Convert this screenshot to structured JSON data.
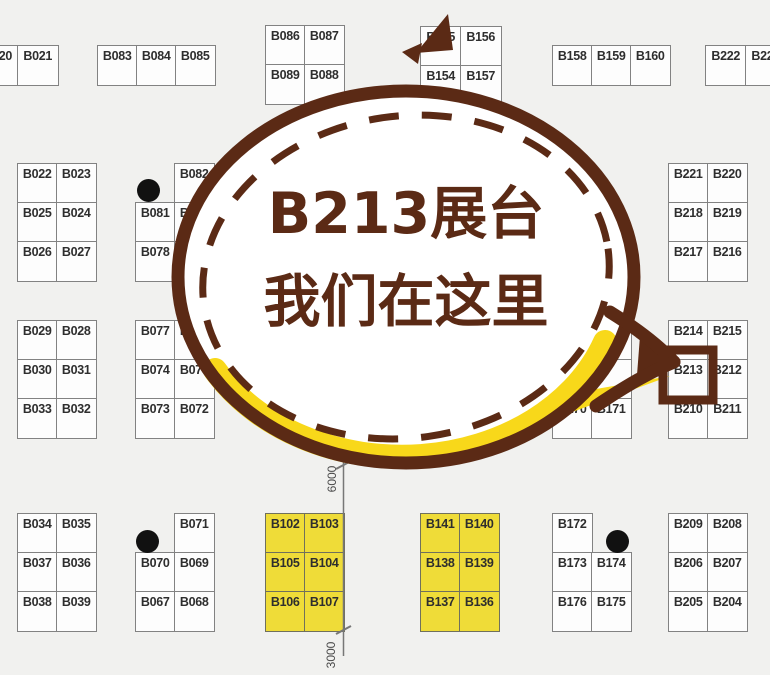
{
  "callout": {
    "line1": "B213展台",
    "line2": "我们在这里",
    "target_booth": "B213"
  },
  "dimension_labels": {
    "top": "6000",
    "bottom": "3000"
  },
  "colors": {
    "brown": "#5B2A15",
    "yellow_accent": "#F8D81A",
    "booth_yellow": "#EFDC38",
    "grid_gray": "#828282",
    "background": "#F1F1EF"
  },
  "blocks": [
    {
      "id": "blk-b020",
      "x": -23,
      "y": 45,
      "cw": 40,
      "ch": 39,
      "fill": "white",
      "rows": [
        [
          "B020",
          "B021"
        ]
      ]
    },
    {
      "id": "blk-b083",
      "x": 97,
      "y": 45,
      "cw": 39,
      "ch": 39,
      "fill": "white",
      "rows": [
        [
          "B083",
          "B084",
          "B085"
        ]
      ]
    },
    {
      "id": "blk-b086",
      "x": 265,
      "y": 25,
      "cw": 39,
      "ch": 39,
      "fill": "white",
      "rows": [
        [
          "B086",
          "B087"
        ],
        [
          "B089",
          "B088"
        ]
      ]
    },
    {
      "id": "blk-b155",
      "x": 420,
      "y": 26,
      "cw": 40,
      "ch": 39,
      "fill": "white",
      "rows": [
        [
          "B155",
          "B156"
        ],
        [
          "B154",
          "B157"
        ]
      ]
    },
    {
      "id": "blk-b158",
      "x": 552,
      "y": 45,
      "cw": 39,
      "ch": 39,
      "fill": "white",
      "rows": [
        [
          "B158",
          "B159",
          "B160"
        ]
      ]
    },
    {
      "id": "blk-b222",
      "x": 705,
      "y": 45,
      "cw": 40,
      "ch": 39,
      "fill": "white",
      "rows": [
        [
          "B222",
          "B223"
        ]
      ]
    },
    {
      "id": "blk-b022",
      "x": 17,
      "y": 163,
      "cw": 39,
      "ch": 39,
      "fill": "white",
      "rows": [
        [
          "B022",
          "B023"
        ],
        [
          "B025",
          "B024"
        ],
        [
          "B026",
          "B027"
        ]
      ]
    },
    {
      "id": "blk-b082",
      "x": 135,
      "y": 163,
      "cw": 39,
      "ch": 39,
      "fill": "white",
      "rows": [
        [
          null,
          "B082"
        ],
        [
          "B081",
          "B080"
        ],
        [
          "B078",
          "B079"
        ]
      ]
    },
    {
      "id": "blk-b221",
      "x": 668,
      "y": 163,
      "cw": 39,
      "ch": 39,
      "fill": "white",
      "rows": [
        [
          "B221",
          "B220"
        ],
        [
          "B218",
          "B219"
        ],
        [
          "B217",
          "B216"
        ]
      ]
    },
    {
      "id": "blk-b029",
      "x": 17,
      "y": 320,
      "cw": 39,
      "ch": 39,
      "fill": "white",
      "rows": [
        [
          "B029",
          "B028"
        ],
        [
          "B030",
          "B031"
        ],
        [
          "B033",
          "B032"
        ]
      ]
    },
    {
      "id": "blk-b077",
      "x": 135,
      "y": 320,
      "cw": 39,
      "ch": 39,
      "fill": "white",
      "rows": [
        [
          "B077",
          "B076"
        ],
        [
          "B074",
          "B075"
        ],
        [
          "B073",
          "B072"
        ]
      ]
    },
    {
      "id": "blk-b170",
      "x": 552,
      "y": 320,
      "cw": 39,
      "ch": 39,
      "fill": "white",
      "rows": [
        [
          "",
          "B167"
        ],
        [
          "",
          ""
        ],
        [
          "B170",
          "B171"
        ]
      ]
    },
    {
      "id": "blk-b214",
      "x": 668,
      "y": 320,
      "cw": 39,
      "ch": 39,
      "fill": "white",
      "rows": [
        [
          "B214",
          "B215"
        ],
        [
          "B213",
          "B212"
        ],
        [
          "B210",
          "B211"
        ]
      ]
    },
    {
      "id": "blk-b034",
      "x": 17,
      "y": 513,
      "cw": 39,
      "ch": 39,
      "fill": "white",
      "rows": [
        [
          "B034",
          "B035"
        ],
        [
          "B037",
          "B036"
        ],
        [
          "B038",
          "B039"
        ]
      ]
    },
    {
      "id": "blk-b071",
      "x": 135,
      "y": 513,
      "cw": 39,
      "ch": 39,
      "fill": "white",
      "rows": [
        [
          null,
          "B071"
        ],
        [
          "B070",
          "B069"
        ],
        [
          "B067",
          "B068"
        ]
      ]
    },
    {
      "id": "blk-b102",
      "x": 265,
      "y": 513,
      "cw": 39,
      "ch": 39,
      "fill": "yellow",
      "rows": [
        [
          "B102",
          "B103"
        ],
        [
          "B105",
          "B104"
        ],
        [
          "B106",
          "B107"
        ]
      ]
    },
    {
      "id": "blk-b141",
      "x": 420,
      "y": 513,
      "cw": 39,
      "ch": 39,
      "fill": "yellow",
      "rows": [
        [
          "B141",
          "B140"
        ],
        [
          "B138",
          "B139"
        ],
        [
          "B137",
          "B136"
        ]
      ]
    },
    {
      "id": "blk-b172",
      "x": 552,
      "y": 513,
      "cw": 39,
      "ch": 39,
      "fill": "white",
      "rows": [
        [
          "B172",
          null
        ],
        [
          "B173",
          "B174"
        ],
        [
          "B176",
          "B175"
        ]
      ]
    },
    {
      "id": "blk-b209",
      "x": 668,
      "y": 513,
      "cw": 39,
      "ch": 39,
      "fill": "white",
      "rows": [
        [
          "B209",
          "B208"
        ],
        [
          "B206",
          "B207"
        ],
        [
          "B205",
          "B204"
        ]
      ]
    }
  ],
  "dots": [
    {
      "x": 148,
      "y": 190
    },
    {
      "x": 147,
      "y": 541
    },
    {
      "x": 617,
      "y": 541
    }
  ],
  "highlight": {
    "booth": "B213",
    "x": 663,
    "y": 350,
    "w": 50,
    "h": 50
  }
}
